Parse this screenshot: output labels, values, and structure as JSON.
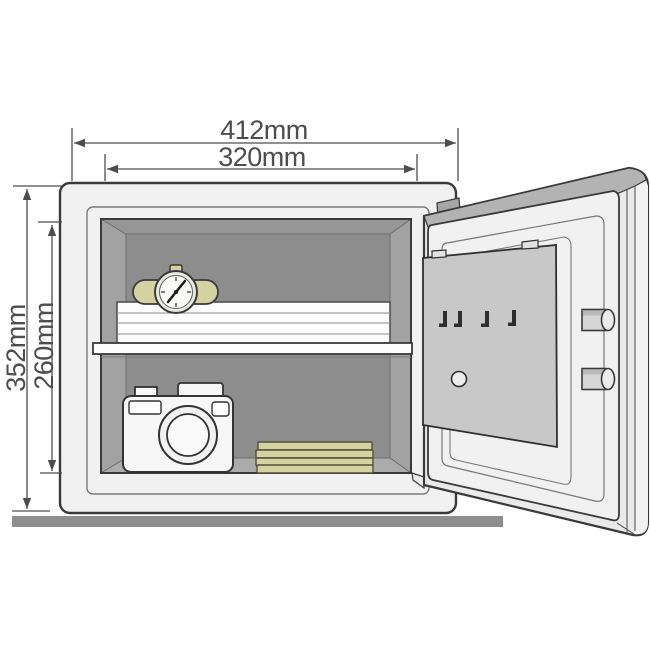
{
  "diagram": {
    "type": "safe-dimension-diagram",
    "labels": {
      "outer_width": "412mm",
      "inner_width": "320mm",
      "outer_height": "352mm",
      "inner_height": "260mm"
    },
    "safe": {
      "door": {
        "key_hooks": 4,
        "locking_bolts": 2,
        "panel_holes": 1
      },
      "shelf_contents": [
        "wristwatch",
        "document-stack"
      ],
      "floor_contents": [
        "camera",
        "gold-bar-stack"
      ]
    },
    "colors": {
      "body": "#f1f1f1",
      "interior_wall": "#a2a2a2",
      "interior_back": "#8d8d8d",
      "accent_gold": "#d5d1a0",
      "dimension_line": "#4d4d4d",
      "base_bar": "#8e8e8e"
    }
  }
}
